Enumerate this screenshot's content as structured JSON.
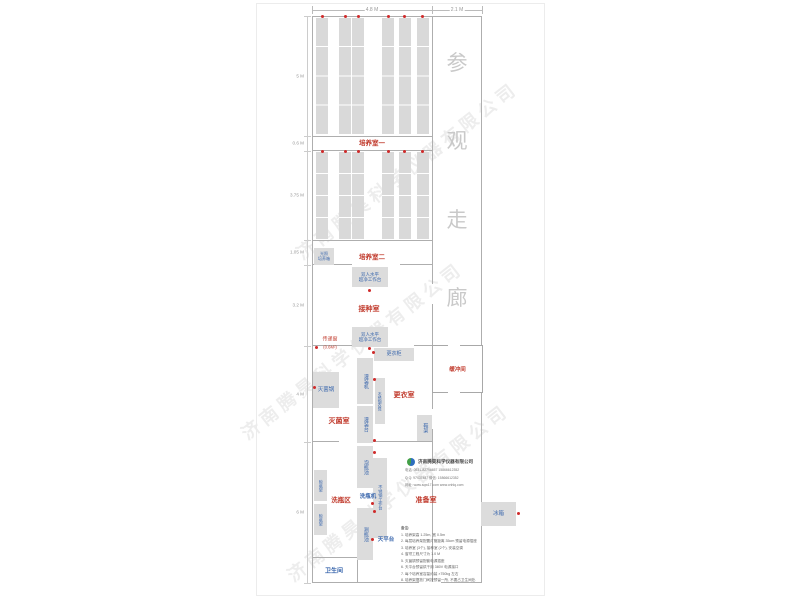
{
  "colors": {
    "accent_red": "#c0392b",
    "blue": "#3a67ad",
    "rack": "#d9d9d9",
    "box": "#dcdcdc",
    "wall": "#aeaeae",
    "dot": "#cf2b2b",
    "dim": "#999999",
    "corridor_text": "#c9c9c9"
  },
  "plan": {
    "sheet": [
      256,
      3,
      289,
      593
    ],
    "walls": [
      [
        312,
        16,
        170,
        1.4
      ],
      [
        312,
        16,
        1.4,
        567
      ],
      [
        481,
        16,
        1.4,
        567
      ],
      [
        312,
        582,
        107,
        1.4
      ],
      [
        441,
        582,
        41,
        1.4
      ],
      [
        432,
        16,
        1.2,
        268
      ],
      [
        432,
        304,
        1.2,
        41
      ],
      [
        432,
        393,
        1.2,
        16
      ],
      [
        432,
        429,
        1.2,
        33
      ],
      [
        432,
        480,
        1.2,
        102
      ],
      [
        312,
        136,
        120,
        0.8
      ],
      [
        312,
        150,
        120,
        1
      ],
      [
        312,
        240,
        120,
        1
      ],
      [
        312,
        264,
        40,
        1
      ],
      [
        400,
        264,
        32,
        1
      ],
      [
        312,
        345,
        42,
        1
      ],
      [
        414,
        345,
        18,
        1
      ],
      [
        312,
        441,
        27,
        1
      ],
      [
        361,
        441,
        71,
        1
      ],
      [
        312,
        557,
        46,
        1.2
      ],
      [
        357,
        557,
        1.2,
        26
      ]
    ],
    "rack_columns": [
      316,
      339,
      352,
      382,
      399,
      417
    ],
    "rack_width": 12,
    "rack_sections": [
      {
        "y": 18,
        "h": 117,
        "rows": 4
      },
      {
        "y": 152,
        "h": 88,
        "rows": 4
      }
    ],
    "power_dots": [
      [
        322,
        16
      ],
      [
        345,
        16
      ],
      [
        358,
        16
      ],
      [
        388,
        16
      ],
      [
        404,
        16
      ],
      [
        422,
        16
      ],
      [
        322,
        151
      ],
      [
        345,
        151
      ],
      [
        358,
        151
      ],
      [
        388,
        151
      ],
      [
        404,
        151
      ],
      [
        422,
        151
      ],
      [
        369,
        290
      ],
      [
        369,
        348
      ],
      [
        316,
        347
      ],
      [
        373,
        352
      ],
      [
        374,
        379
      ],
      [
        374,
        440
      ],
      [
        314,
        387
      ],
      [
        374,
        452
      ],
      [
        372,
        503
      ],
      [
        374,
        511
      ],
      [
        372,
        539
      ],
      [
        518,
        513
      ]
    ]
  },
  "dim_top": {
    "line_y": 10,
    "x1": 312,
    "x2": 482,
    "ticks": [
      312,
      432,
      482
    ],
    "labels": [
      {
        "text": "4.8 M",
        "cx": 372
      },
      {
        "text": "2.1 M",
        "cx": 457
      }
    ]
  },
  "dim_left": {
    "line_x": 307,
    "y1": 16,
    "y2": 583,
    "ticks": [
      16,
      136,
      151,
      240,
      265,
      346,
      442,
      583
    ],
    "labels": [
      {
        "text": "5 M",
        "cy": 76
      },
      {
        "text": "0.6 M",
        "cy": 143
      },
      {
        "text": "3.75 M",
        "cy": 195
      },
      {
        "text": "1.05 M",
        "cy": 252
      },
      {
        "text": "3.2 M",
        "cy": 305
      },
      {
        "text": "4 M",
        "cy": 394
      },
      {
        "text": "6 M",
        "cy": 512
      }
    ]
  },
  "corridor": {
    "label": "参观走廊",
    "chars": [
      "参",
      "观",
      "走",
      "廊"
    ],
    "cx": 457,
    "char_cy": [
      62,
      140,
      219,
      297
    ],
    "font_size": 21
  },
  "room_labels": [
    {
      "text": "培养室一",
      "cx": 372,
      "cy": 142,
      "fs": 6.5
    },
    {
      "text": "培养室二",
      "cx": 372,
      "cy": 256,
      "fs": 6.5
    },
    {
      "text": "接种室",
      "cx": 369,
      "cy": 309,
      "fs": 7
    },
    {
      "text": "更衣室",
      "cx": 404,
      "cy": 395,
      "fs": 7
    },
    {
      "text": "灭菌室",
      "cx": 339,
      "cy": 421,
      "fs": 7
    },
    {
      "text": "洗瓶区",
      "cx": 341,
      "cy": 499,
      "fs": 6.5
    },
    {
      "text": "准备室",
      "cx": 426,
      "cy": 500,
      "fs": 7
    }
  ],
  "equipment": [
    {
      "id": "light-incubator",
      "label": "光照培养箱",
      "lines": [
        "光照",
        "培养箱"
      ],
      "x": 314,
      "y": 248,
      "w": 20,
      "h": 17,
      "fs": 4,
      "vertical": false
    },
    {
      "id": "clean-bench-1",
      "label": "双人水平超净工作台",
      "lines": [
        "双人水平",
        "超净工作台"
      ],
      "x": 352,
      "y": 267,
      "w": 36,
      "h": 20,
      "fs": 4.5,
      "vertical": false
    },
    {
      "id": "clean-bench-2",
      "label": "双人水平超净工作台",
      "lines": [
        "双人水平",
        "超净工作台"
      ],
      "x": 352,
      "y": 327,
      "w": 36,
      "h": 20,
      "fs": 4.5,
      "vertical": false
    },
    {
      "id": "locker",
      "label": "更衣柜",
      "lines": [
        "更衣柜"
      ],
      "x": 374,
      "y": 348,
      "w": 40,
      "h": 13,
      "fs": 5,
      "vertical": false
    },
    {
      "id": "filling-machine",
      "label": "灌装机",
      "lines": [
        "灌装机"
      ],
      "x": 357,
      "y": 358,
      "w": 16,
      "h": 46,
      "fs": 5,
      "vertical": true
    },
    {
      "id": "filling-table",
      "label": "灌装台",
      "lines": [
        "灌装台"
      ],
      "x": 357,
      "y": 406,
      "w": 16,
      "h": 37,
      "fs": 5,
      "vertical": true
    },
    {
      "id": "steel-bench",
      "label": "不锈钢衣凳",
      "lines": [
        "不锈钢衣凳"
      ],
      "x": 375,
      "y": 378,
      "w": 10,
      "h": 46,
      "fs": 3.8,
      "vertical": true
    },
    {
      "id": "sterilizer",
      "label": "灭菌锅",
      "lines": [
        "灭菌锅"
      ],
      "x": 313,
      "y": 372,
      "w": 26,
      "h": 36,
      "fs": 5.5,
      "vertical": false
    },
    {
      "id": "shoe-rack",
      "label": "鞋架",
      "lines": [
        "鞋架"
      ],
      "x": 417,
      "y": 415,
      "w": 15,
      "h": 26,
      "fs": 5,
      "vertical": true
    },
    {
      "id": "soak-pool",
      "label": "泡瓶池",
      "lines": [
        "泡瓶池"
      ],
      "x": 357,
      "y": 446,
      "w": 16,
      "h": 42,
      "fs": 5,
      "vertical": true
    },
    {
      "id": "steel-worktable",
      "label": "不锈钢工作台",
      "lines": [
        "不锈钢工作台"
      ],
      "x": 373,
      "y": 458,
      "w": 14,
      "h": 80,
      "fs": 4.2,
      "vertical": true
    },
    {
      "id": "rinse-pool",
      "label": "涮瓶池",
      "lines": [
        "涮瓶池"
      ],
      "x": 357,
      "y": 508,
      "w": 16,
      "h": 52,
      "fs": 5,
      "vertical": true
    },
    {
      "id": "dry-rack-1",
      "label": "晾瓶架",
      "lines": [
        "晾瓶架"
      ],
      "x": 314,
      "y": 470,
      "w": 13,
      "h": 31,
      "fs": 4,
      "vertical": true
    },
    {
      "id": "dry-rack-2",
      "label": "晾瓶架",
      "lines": [
        "晾瓶架"
      ],
      "x": 314,
      "y": 504,
      "w": 13,
      "h": 31,
      "fs": 4,
      "vertical": true
    },
    {
      "id": "refrigerator",
      "label": "冰箱",
      "lines": [
        "冰箱"
      ],
      "x": 481,
      "y": 502,
      "w": 35,
      "h": 24,
      "fs": 5.5,
      "vertical": false
    }
  ],
  "blue_labels": [
    {
      "id": "bottle-washer",
      "text": "洗瓶机",
      "cx": 368,
      "cy": 496,
      "fs": 5.5
    },
    {
      "id": "balance-table",
      "text": "天平台",
      "cx": 386,
      "cy": 539,
      "fs": 5.5
    },
    {
      "id": "bathroom",
      "text": "卫生间",
      "cx": 334,
      "cy": 570,
      "fs": 6
    }
  ],
  "red_small_labels": [
    {
      "id": "pass-window",
      "text": "传递窗",
      "cx": 330,
      "cy": 339,
      "fs": 5
    },
    {
      "id": "pass-window-size",
      "text": "(0.6M²)",
      "cx": 330,
      "cy": 347,
      "fs": 4.2
    }
  ],
  "buffer_room": {
    "label": "缓冲间",
    "x": 432,
    "y": 345,
    "w": 51,
    "h": 48,
    "fs": 5.5
  },
  "company": {
    "name": "济南腾昊科学仪器有限公司",
    "lines": [
      "电话: 0531-82796657  15866612352",
      "Q Q: 97437487    微信: 15866612352",
      "网址: www.sqw17.com   www.cnhlq.com"
    ],
    "x": 405,
    "y": 455
  },
  "notes": {
    "header": "备注:",
    "items": [
      "1. 培养架高 1.25m, 宽 0.5m",
      "2. 每层培养架配置灯管距离 35cm 预留电源插座",
      "3. 培养室 (3个), 接种室 (2个), 安装空调",
      "4. 窗帘工程尺寸为 1.0 M",
      "5. 灭菌锅预留配套电源插座",
      "6. 天平台预留烘干用 380V 电源接口",
      "7. 每个培养室容量约装 ×750kg 左右",
      "8. 培养架摆放门间按预留一所, 不要占卫生间处."
    ],
    "x": 401,
    "y": 525
  },
  "watermark": {
    "text": "济南腾昊科学仪器有限公司",
    "positions": [
      {
        "x": 407,
        "y": 170
      },
      {
        "x": 352,
        "y": 350
      },
      {
        "x": 398,
        "y": 492
      }
    ]
  }
}
